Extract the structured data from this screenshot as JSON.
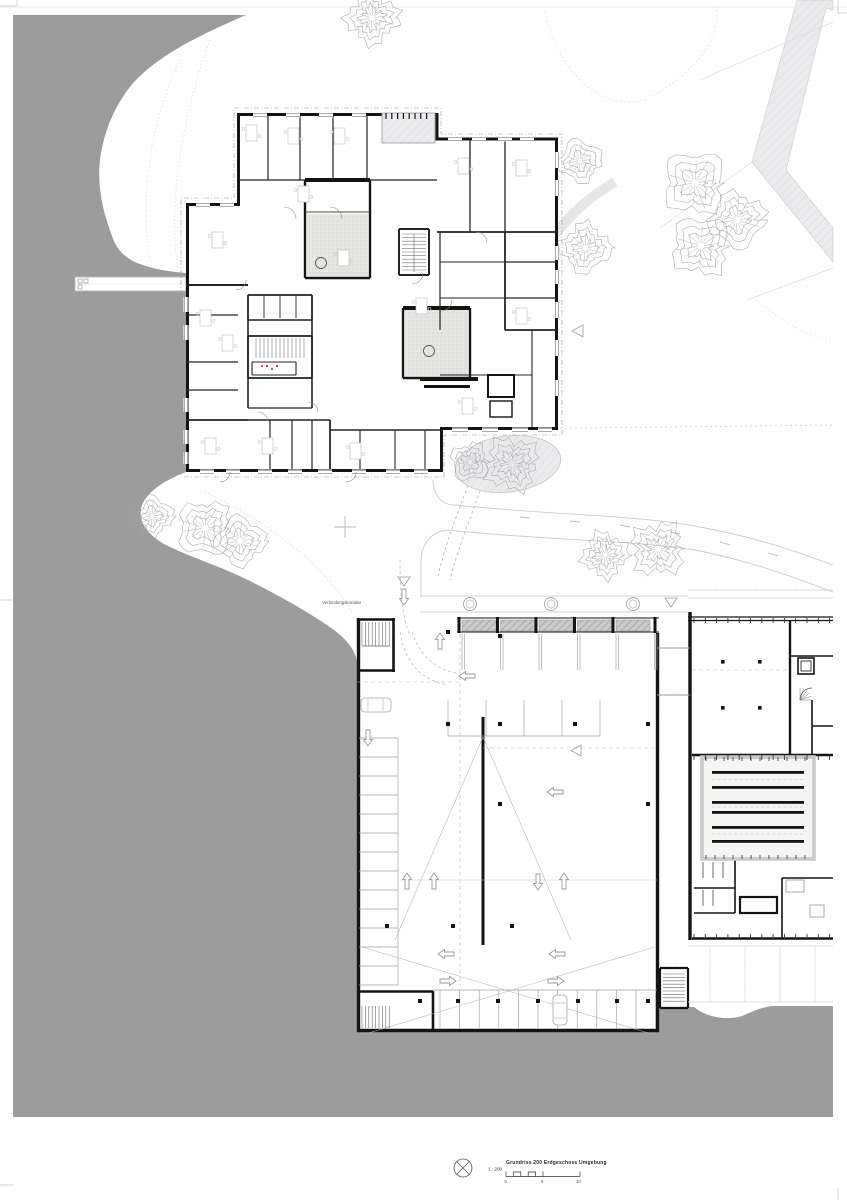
{
  "drawing": {
    "corridor_label": "Verbindungskorridor",
    "title": "Grundriss 200 Erdgeschoss Umgebung",
    "scale_label": "1 : 200",
    "scale_ticks": [
      "0",
      "5",
      "10"
    ],
    "colors": {
      "water_gray": "#9c9c9c",
      "wall_black": "#1a1a1a",
      "courtyard_fill": "#e5e5e2",
      "skylight_fill": "#c9c9c9",
      "hatch_band": "#ebebee",
      "accent_red": "#cc3333"
    },
    "icons": [
      "north-arrow-icon",
      "down-triangle-marker",
      "left-triangle-marker"
    ]
  }
}
